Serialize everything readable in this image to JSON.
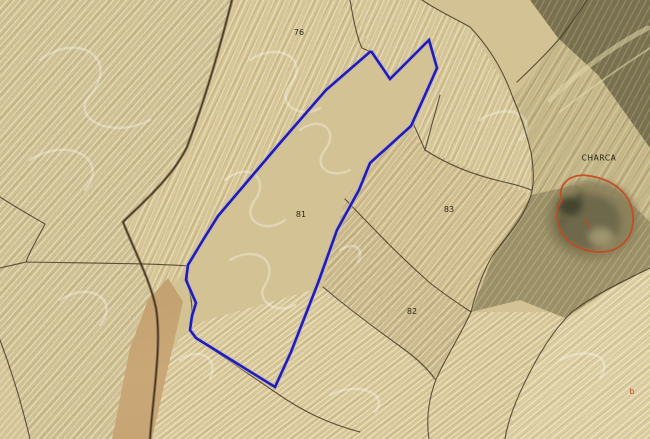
{
  "map": {
    "kind": "aerial-cadastral-view",
    "parcel_labels": [
      {
        "text": "76"
      },
      {
        "text": "81"
      },
      {
        "text": "83"
      },
      {
        "text": "82"
      }
    ],
    "place_labels": [
      {
        "text": "CHARCA"
      }
    ],
    "subparcel_labels": [
      {
        "text": "b"
      }
    ],
    "colors": {
      "highlight_outline": "#1e1eb4",
      "annotation_red": "#c7481f",
      "label_text": "#2b2518",
      "terrain_base": "#d3c293"
    }
  }
}
